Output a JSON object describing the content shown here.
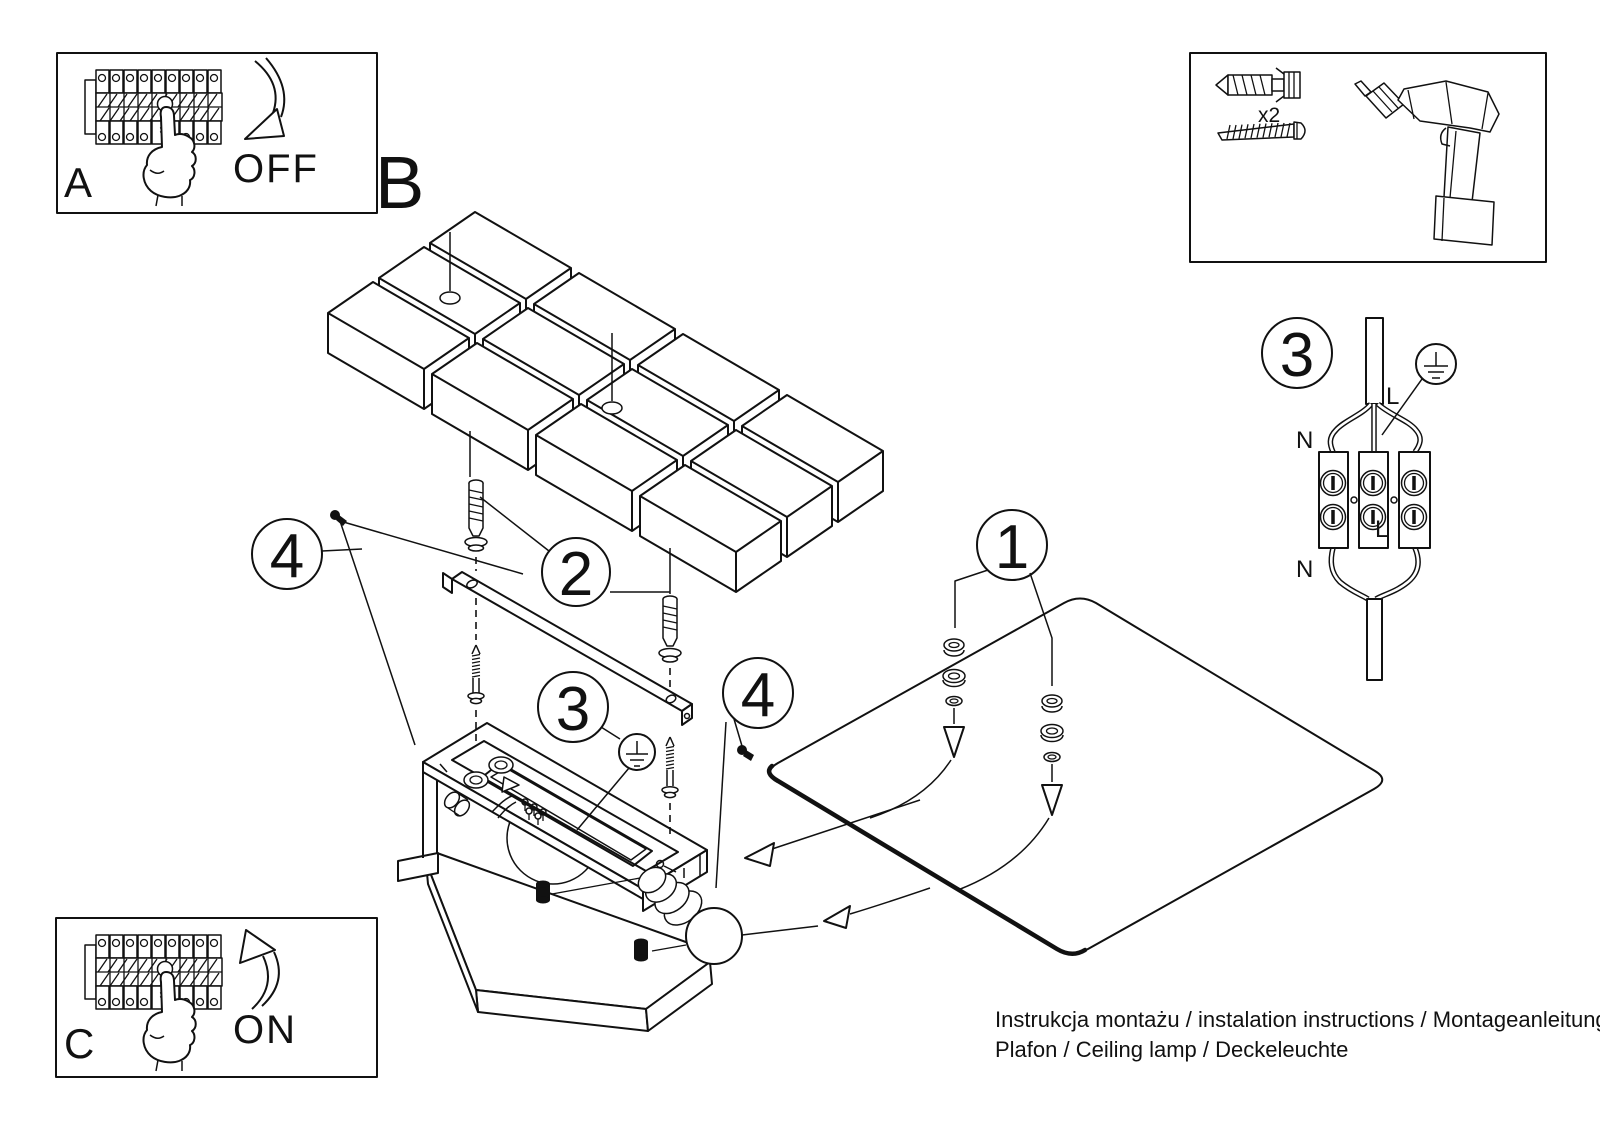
{
  "sheet": {
    "background": "#ffffff",
    "line_color": "#111111"
  },
  "inset_power_off": {
    "label": "A",
    "caption": "OFF"
  },
  "inset_power_on": {
    "label": "C",
    "caption": "ON"
  },
  "tools_box": {
    "anchor_quantity": "x2"
  },
  "assembly_view": {
    "label": "B"
  },
  "callouts": {
    "step1": "1",
    "step2": "2",
    "step3": "3",
    "step4": "4"
  },
  "wiring_detail": {
    "label": "3",
    "neutral_top": "N",
    "neutral_bottom": "N",
    "live_top": "L",
    "live_bottom": "L",
    "ground_icon": "earth-ground-symbol"
  },
  "footer": {
    "line1": "Instrukcja montażu / instalation instructions / Montageanleitung",
    "line2": "Plafon / Ceiling lamp / Deckeleuchte"
  }
}
